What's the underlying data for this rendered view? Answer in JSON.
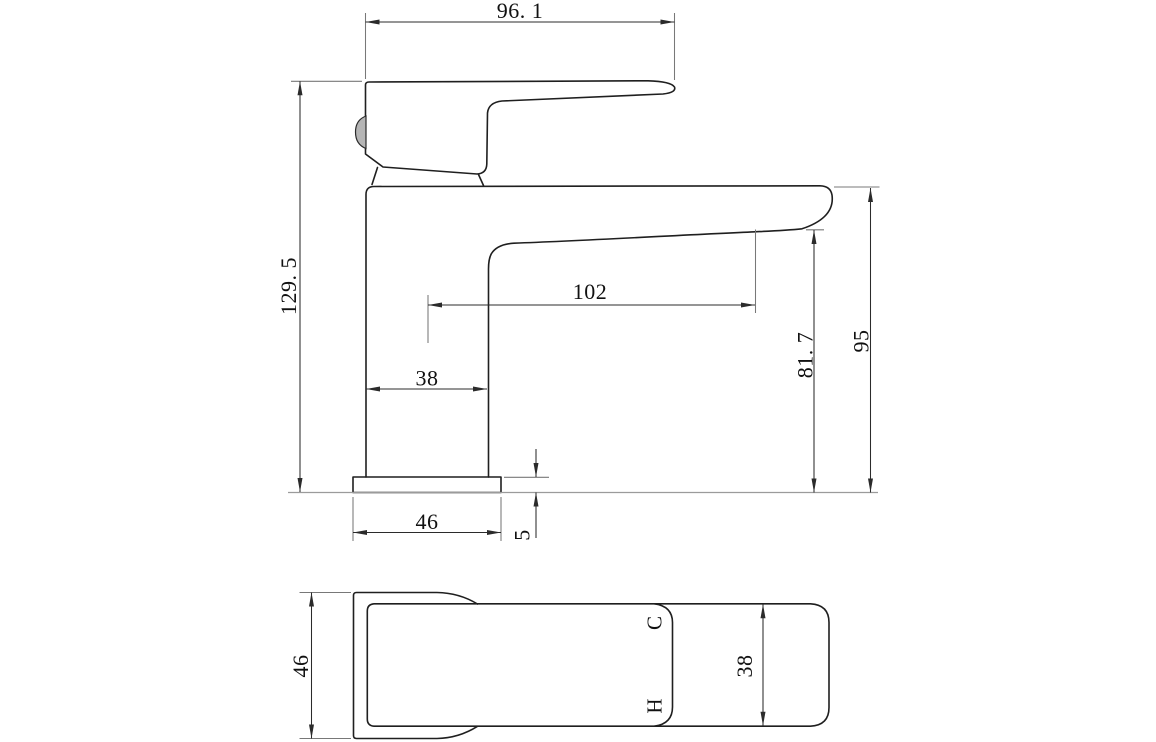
{
  "side_view": {
    "handle_length": "96. 1",
    "overall_height": "129. 5",
    "spout_reach": "102",
    "body_width": "38",
    "outlet_height": "81. 7",
    "spout_height": "95",
    "base_width": "46",
    "base_thickness": "5"
  },
  "plan_view": {
    "overall_depth": "46",
    "spout_width": "38",
    "cold_label": "C",
    "hot_label": "H"
  },
  "colors": {
    "background": "#ffffff",
    "object_line": "#1f1f1f",
    "dimension_line": "#2b2b2b",
    "extension_line": "#787878",
    "ground_line": "#9b9b9b",
    "aerator_fill": "#b5b5b5",
    "text": "#111111"
  }
}
